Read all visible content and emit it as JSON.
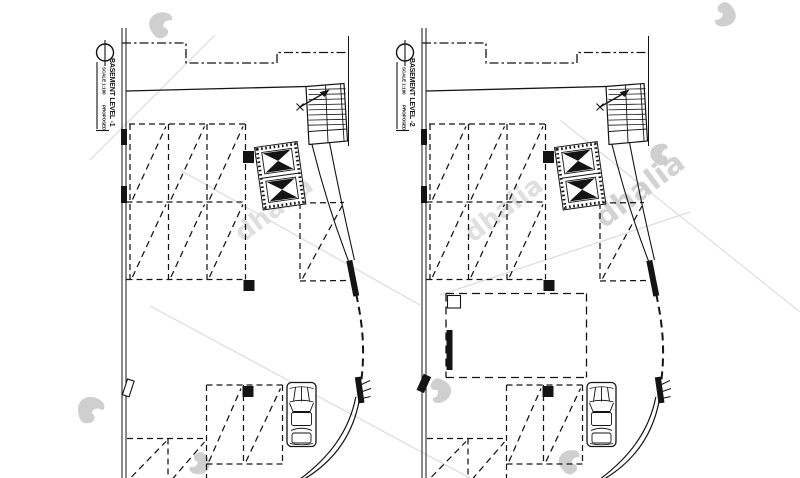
{
  "colors": {
    "ink": "#141414",
    "paper": "#ffffff",
    "watermark_strong": "#c7c7c7",
    "watermark_faint": "#dcdcdc"
  },
  "plans": [
    {
      "title": "BASEMENT LEVEL -1",
      "scale_label": "SCALE 1:100",
      "status_label": "PROPOSED",
      "features": {
        "door_style": "outline",
        "has_ramp_box": false
      }
    },
    {
      "title": "BASEMENT LEVEL -2",
      "scale_label": "SCALE 1:100",
      "status_label": "PROPOSED",
      "features": {
        "door_style": "filled",
        "has_ramp_box": true
      }
    }
  ],
  "watermark": {
    "text": "dhalia"
  },
  "icons": {
    "elevator": "elevator-core-icon",
    "stair": "staircase-icon",
    "car": "car-top-view-icon",
    "title_bubble": "title-bubble-icon"
  }
}
